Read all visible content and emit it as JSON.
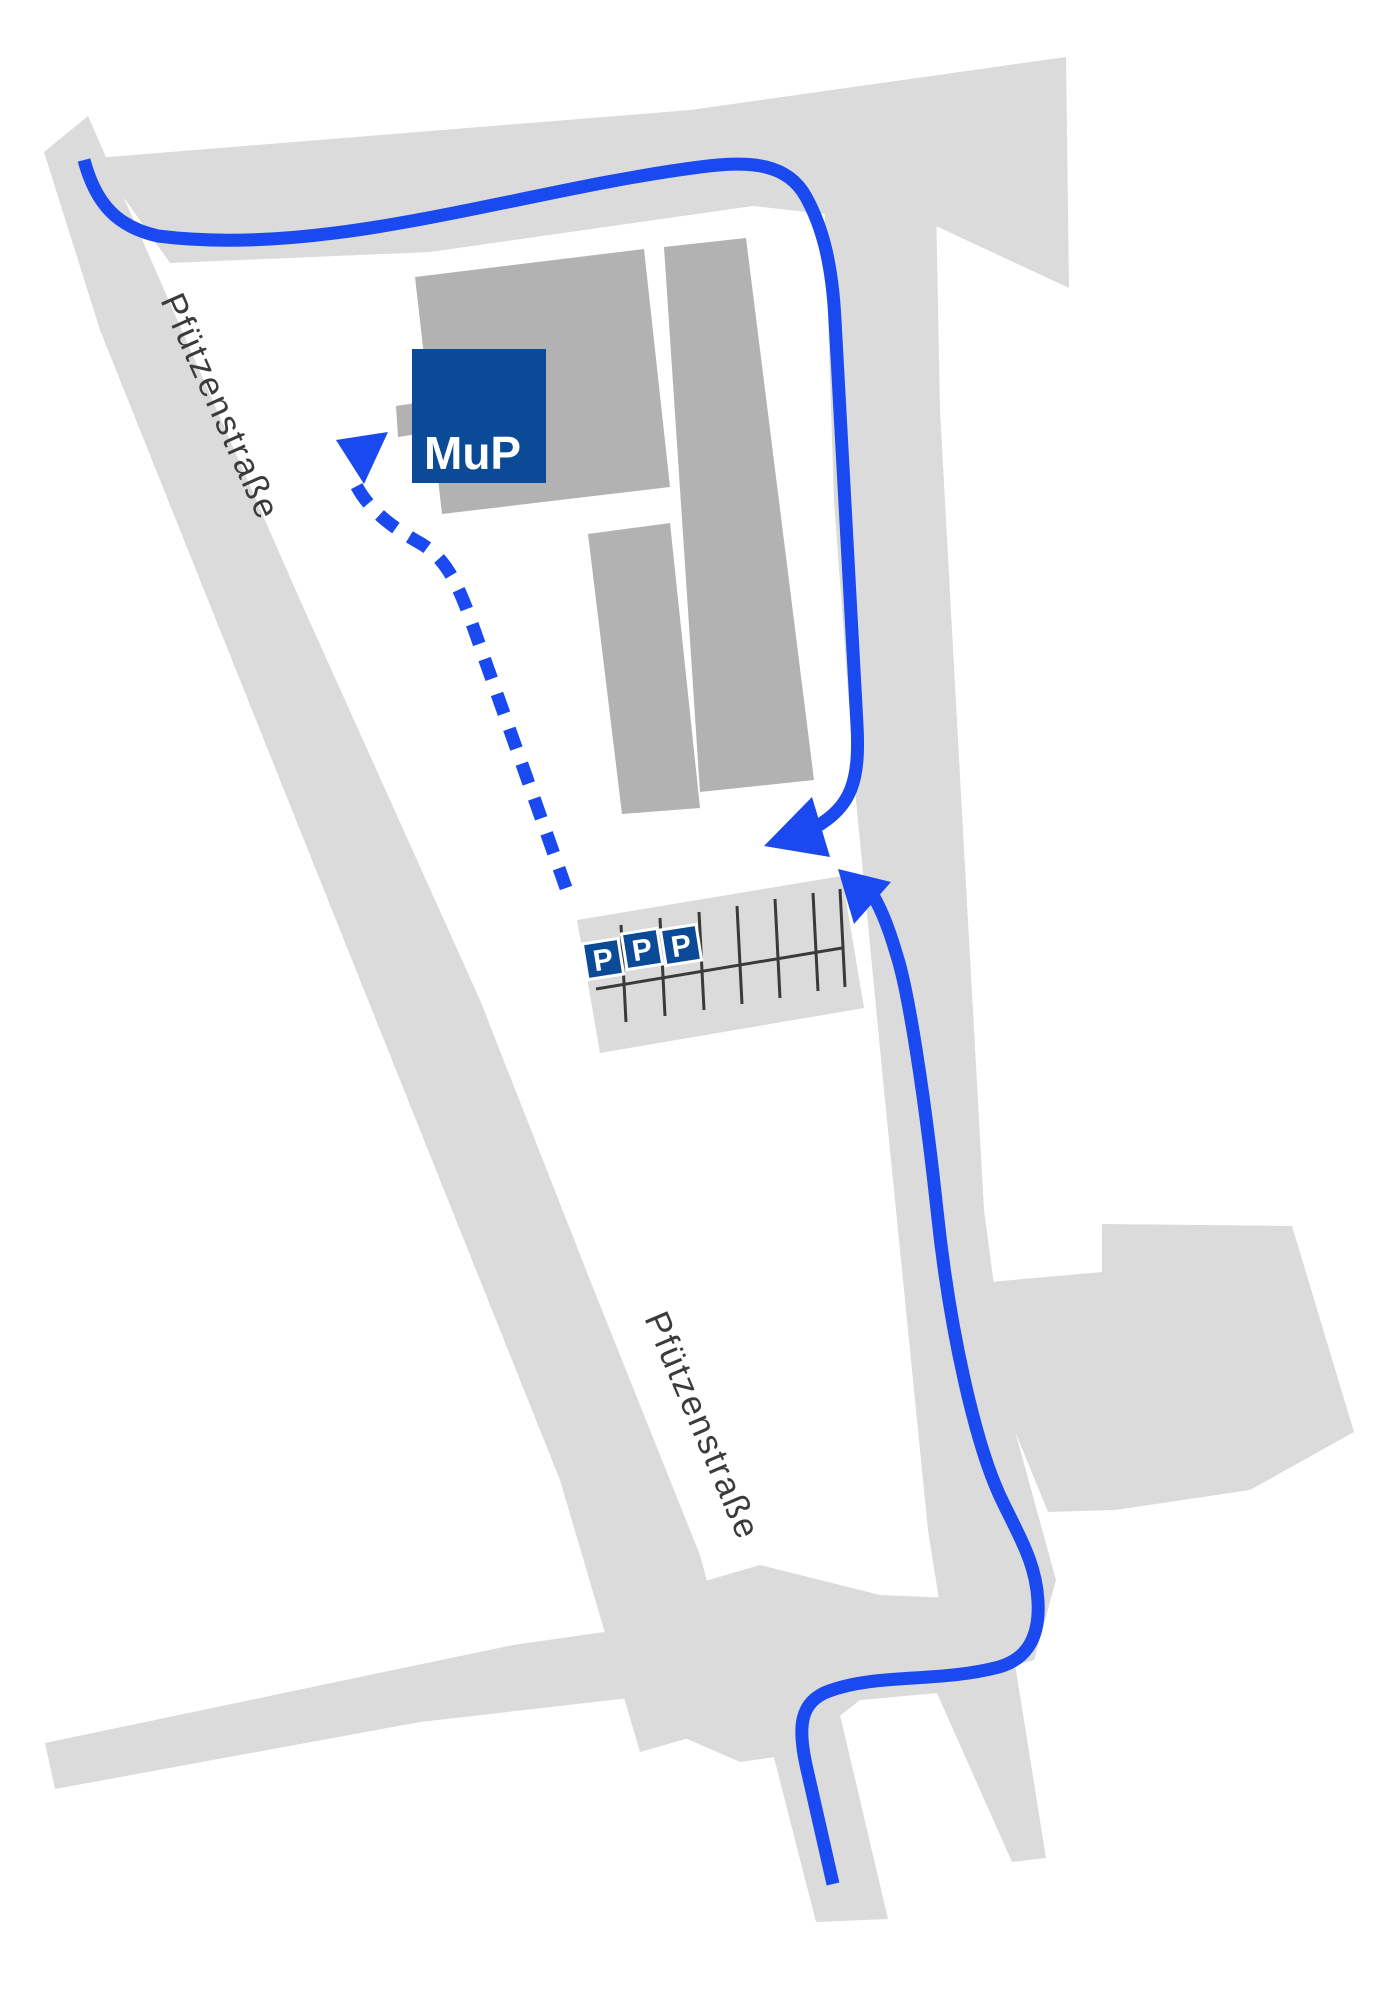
{
  "map": {
    "logo": {
      "text": "MuP"
    },
    "streets": {
      "top": "Pfützenstraße",
      "bottom": "Pfützenstraße"
    },
    "parking": {
      "sign": "P",
      "sign_count": 3
    },
    "colors": {
      "background": "#ffffff",
      "road": "#dbdbdb",
      "building": "#b2b2b2",
      "route": "#1a49f0",
      "brand_blue": "#0a4a96",
      "parking_line": "#3a3a3a",
      "street_text": "#3b3b3b",
      "logo_text": "#ffffff"
    }
  }
}
